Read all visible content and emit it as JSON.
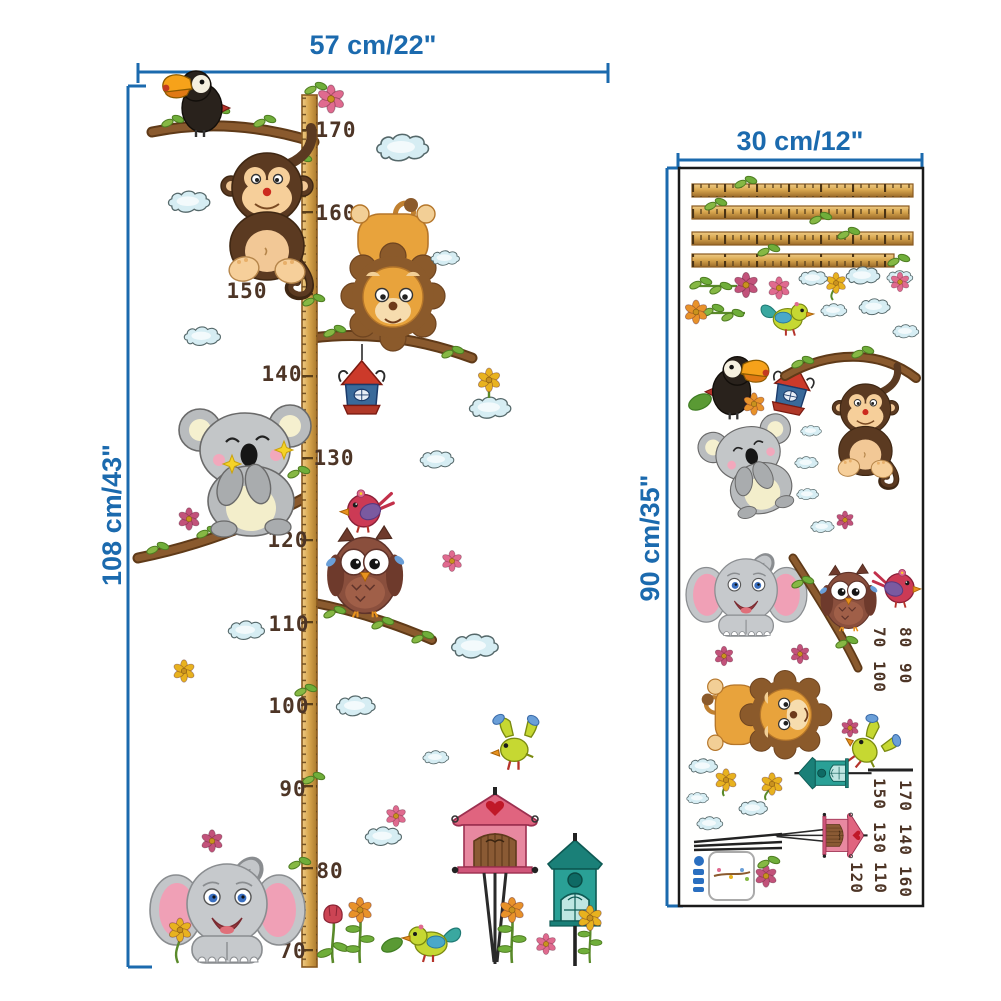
{
  "main_chart": {
    "width_label": "57 cm/22\"",
    "height_label": "108 cm/43\"",
    "ruler_numbers": [
      {
        "value": "170",
        "side": "right"
      },
      {
        "value": "160",
        "side": "right"
      },
      {
        "value": "150",
        "side": "left"
      },
      {
        "value": "140",
        "side": "left"
      },
      {
        "value": "130",
        "side": "right"
      },
      {
        "value": "120",
        "side": "left"
      },
      {
        "value": "110",
        "side": "left"
      },
      {
        "value": "100",
        "side": "left"
      },
      {
        "value": "90",
        "side": "left"
      },
      {
        "value": "80",
        "side": "right"
      },
      {
        "value": "70",
        "side": "left"
      }
    ],
    "stickers": [
      "toucan",
      "monkey",
      "lion",
      "hanging-birdhouse",
      "koala",
      "owl",
      "red-bird",
      "elephant",
      "green-bird-flying",
      "green-bird-standing",
      "pink-birdhouse",
      "teal-birdhouse",
      "clouds",
      "flowers",
      "branches",
      "ruler-pole"
    ]
  },
  "sticker_sheet": {
    "width_label": "30 cm/12\"",
    "height_label": "90 cm/35\"",
    "ruler_strip_count": 4,
    "rotated_numbers": [
      "70",
      "80",
      "100",
      "90",
      "150",
      "170",
      "130",
      "140",
      "120",
      "110",
      "160"
    ],
    "stickers": [
      "ruler-strips",
      "flower-stems",
      "red-flower",
      "pink-flower",
      "green-bird",
      "yellow-flower",
      "clouds",
      "toucan",
      "hanging-birdhouse",
      "branch-with-monkey",
      "koala",
      "leaf",
      "orange-flower",
      "elephant",
      "branch",
      "owl",
      "red-bird",
      "lion",
      "green-bird-flying",
      "teal-birdhouse",
      "pink-birdhouse",
      "number-stickers",
      "brand-sticker"
    ]
  },
  "colors": {
    "dimension_blue": "#1b6aae",
    "ruler_wood": "#d9a74f",
    "ruler_tick": "#6b4a1e",
    "number_brown": "#4d3526",
    "panel_border": "#1a1a1a",
    "cloud_fill": "#d6edf3",
    "background": "#ffffff"
  }
}
